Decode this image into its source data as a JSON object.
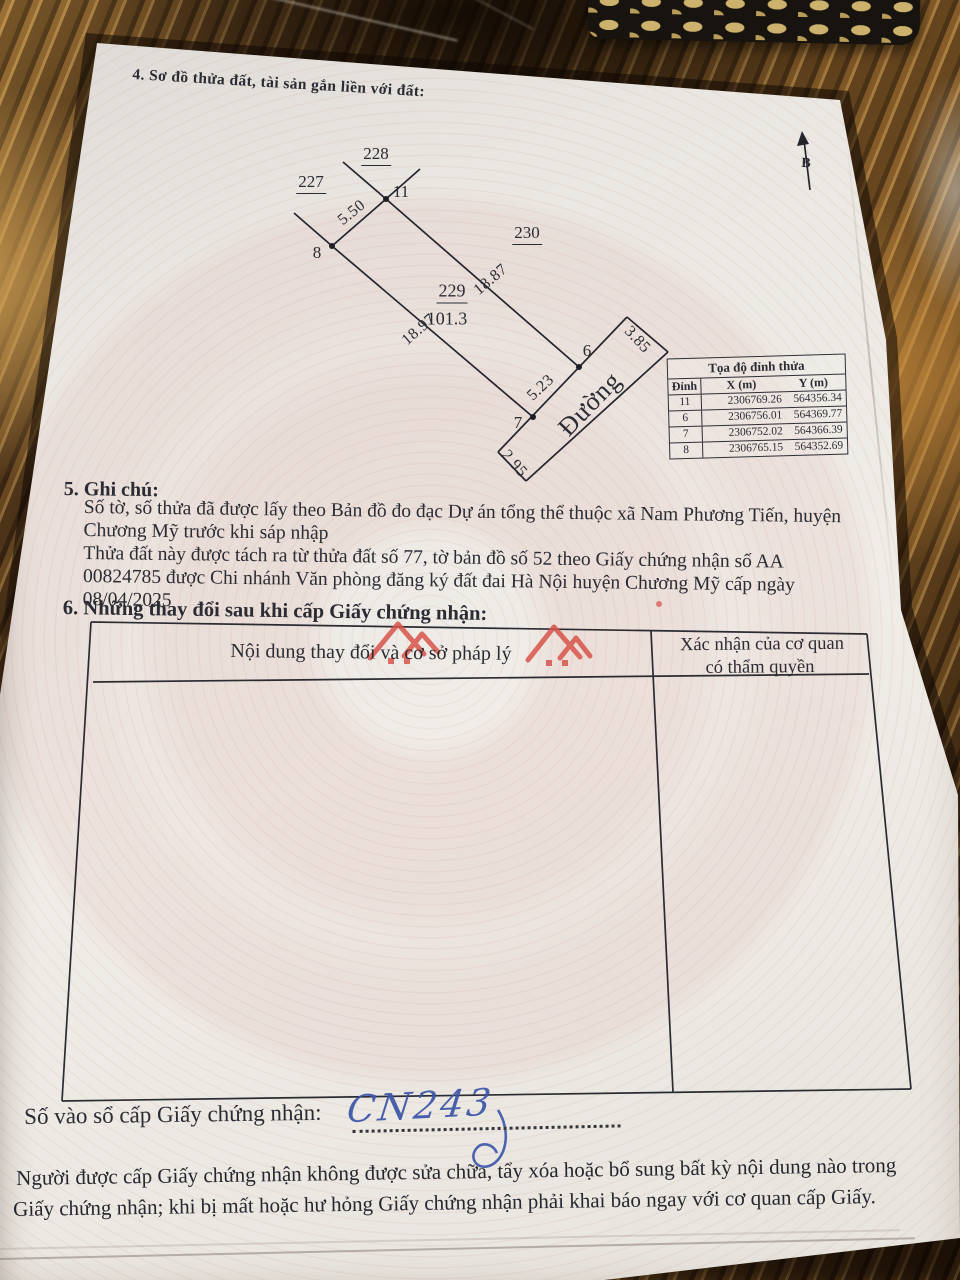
{
  "page": {
    "section4_title": "4. Sơ đồ thửa đất, tài sản gắn liền với đất:",
    "section5_title": "5. Ghi chú:",
    "notes": [
      "Số tờ, số thửa đã được lấy theo Bản đồ đo đạc Dự án tổng thể thuộc xã Nam Phương Tiến, huyện",
      "Chương Mỹ trước khi sáp nhập",
      "Thửa đất này được tách ra từ thửa đất số 77, tờ bản đồ số 52 theo Giấy chứng nhận số AA",
      "00824785 được Chi nhánh Văn phòng đăng ký đất đai Hà Nội huyện Chương Mỹ cấp ngày",
      "08/04/2025"
    ],
    "section6_title": "6. Những thay đổi sau khi cấp Giấy chứng nhận:",
    "registry_label": "Số vào sổ cấp Giấy chứng nhận:",
    "registry_value_handwritten": "CN243",
    "footer_lines": [
      "Người được cấp Giấy chứng nhận không được sửa chữa, tẩy xóa hoặc bổ sung bất kỳ nội dung nào trong",
      "Giấy chứng nhận; khi bị mất hoặc hư hỏng Giấy chứng nhận phải khai báo ngay với cơ quan cấp Giấy."
    ]
  },
  "diagram": {
    "north_label": "B",
    "road_label": "Đường",
    "parcels": {
      "left": "227",
      "top": "228",
      "right": "230",
      "center": "229",
      "center_area": "101.3"
    },
    "vertices": {
      "v11": "11",
      "v8": "8",
      "v6": "6",
      "v7": "7"
    },
    "dimensions": {
      "edge_8_11": "5.50",
      "edge_11_6": "18.87",
      "edge_8_7": "18.97",
      "edge_7_6": "5.23",
      "road_width_top": "3.85",
      "road_width_bottom": "2.95"
    }
  },
  "coord_table": {
    "title": "Tọa độ đỉnh thửa",
    "headers": [
      "Đỉnh",
      "X (m)",
      "Y (m)"
    ],
    "rows": [
      [
        "11",
        "2306769.26",
        "564356.34"
      ],
      [
        "6",
        "2306756.01",
        "564369.77"
      ],
      [
        "7",
        "2306752.02",
        "564366.39"
      ],
      [
        "8",
        "2306765.15",
        "564352.69"
      ]
    ]
  },
  "changes_table": {
    "col1_header": "Nội dung thay đổi và cơ sở pháp lý",
    "col2_header_line1": "Xác nhận của cơ quan",
    "col2_header_line2": "có thẩm quyền"
  },
  "colors": {
    "paper": "#eae7e2",
    "ink": "#2b2b33",
    "handwriting_blue": "#3b55a8",
    "watermark_red": "#d8544a",
    "guilloche_pink": "#cf8580"
  }
}
